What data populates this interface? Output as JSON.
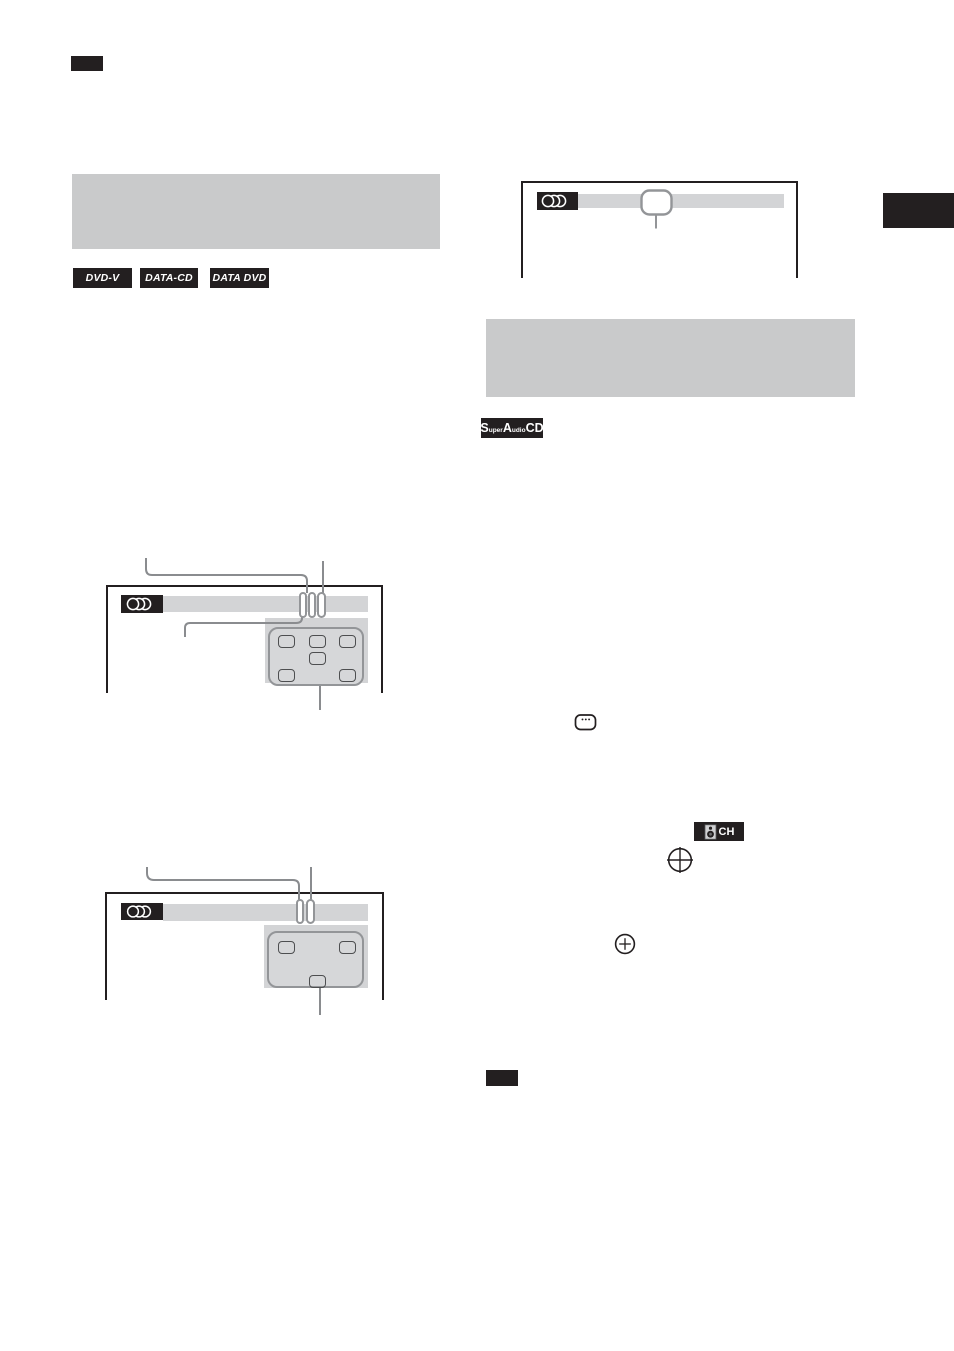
{
  "document": {
    "kind": "instruction-manual-page",
    "columns": 2
  },
  "colors": {
    "ink_black": "#231f20",
    "heading_panel_gray": "#c9cacb",
    "screen_bar_gray": "#d3d4d6",
    "remote_gray": "#d6d7d9",
    "outline_gray": "#939598",
    "callout_gray": "#8a8c8f"
  },
  "disc_format_badges": [
    {
      "label": "DVD-V"
    },
    {
      "label": "DATA-CD"
    },
    {
      "label": "DATA DVD"
    }
  ],
  "super_audio_cd_badge": {
    "s": "S",
    "uper": "uper",
    "a": "A",
    "udio": "udio",
    "cd": "CD"
  },
  "multi_channel_badge": {
    "label": "CH"
  },
  "icons": {
    "multi-disc-icon": "three overlapping circle outlines, white on black",
    "highlight-box-icon": "rounded rectangle outline (menu highlight)",
    "pill-highlight-icon": "vertical rounded pill outline (menu highlight)",
    "subtitle-button-icon": "rounded rectangle with three dots",
    "speaker-icon": "speaker cabinet with two cones",
    "enter-button-icon": "plus sign inside a circle",
    "remote-button-icon": "rounded square button outline",
    "note-badge": "solid black rectangle label",
    "page-edge-tab": "solid black chapter tab on page edge"
  }
}
